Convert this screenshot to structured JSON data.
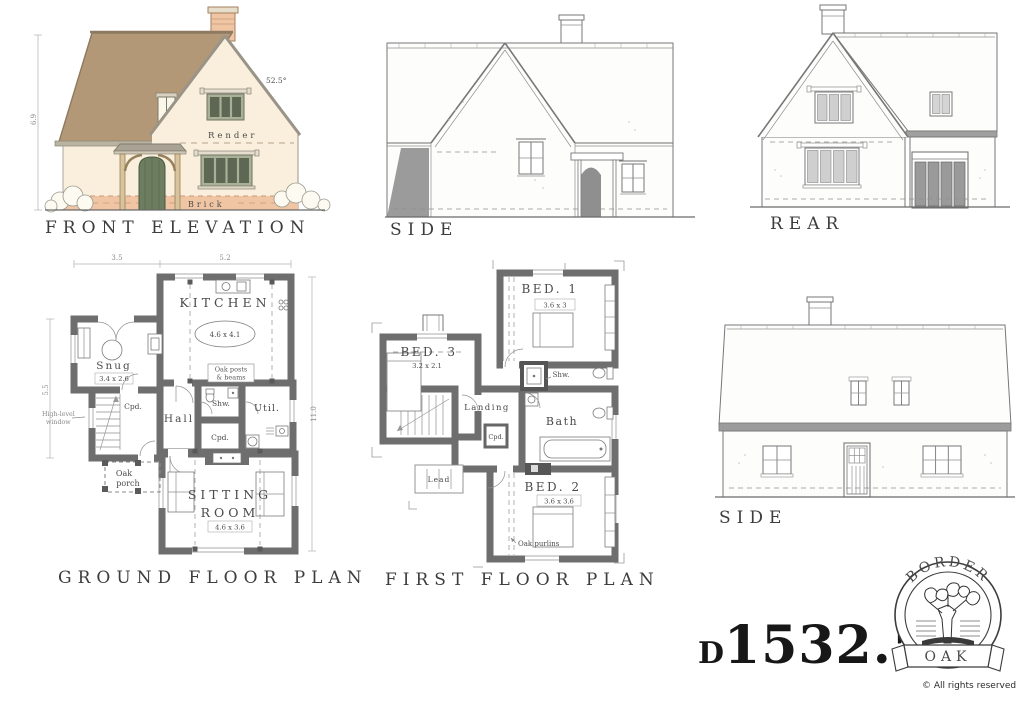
{
  "titles": {
    "front": "FRONT ELEVATION",
    "side_top": "SIDE",
    "rear": "REAR",
    "ground": "GROUND FLOOR PLAN",
    "first": "FIRST FLOOR PLAN",
    "side_bottom": "SIDE"
  },
  "front_elevation": {
    "pitch": "52.5°",
    "render_label": "Render",
    "brick_label": "Brick",
    "height_dim": "6.9"
  },
  "ground_floor": {
    "dim_width_left": "3.5",
    "dim_width_right": "5.2",
    "dim_depth_left": "5.5",
    "dim_depth_right": "11.0",
    "kitchen": "KITCHEN",
    "kitchen_size": "4.6 x 4.1",
    "snug": "Snug",
    "snug_size": "3.4 x 2.6",
    "oak_posts_line1": "Oak posts",
    "oak_posts_line2": "& beams",
    "hall": "Hall",
    "cpd_stairs": "Cpd.",
    "shw": "Shw.",
    "util": "Util.",
    "cpd_lobby": "Cpd.",
    "high_level_line1": "High-level",
    "high_level_line2": "window",
    "porch_line1": "Oak",
    "porch_line2": "porch",
    "sitting_line1": "SITTING",
    "sitting_line2": "ROOM",
    "sitting_size": "4.6 x 3.6"
  },
  "first_floor": {
    "bed1": "BED. 1",
    "bed1_size": "3.6 x 3",
    "bed3": "BED. 3",
    "bed3_size": "3.2 x 2.1",
    "landing": "Landing",
    "cpd": "Cpd.",
    "shw": "Shw.",
    "bath": "Bath",
    "lead": "Lead",
    "bed2": "BED. 2",
    "bed2_size": "3.6 x 3.6",
    "oak_purlins": "Oak purlins"
  },
  "brand": {
    "arc_text": "BORDER",
    "banner_text": "OAK",
    "rights": "© All rights reserved",
    "number_prefix": "D",
    "number": "1532.5",
    "number_suffix": "A"
  },
  "colors": {
    "roof": "#b39878",
    "wall": "#f9efdc",
    "brick": "#f0c5a4",
    "door": "#6d7d60",
    "window_frame": "#a9b098",
    "glazing": "#5d6753",
    "plan_wall": "#6e6e6e"
  }
}
